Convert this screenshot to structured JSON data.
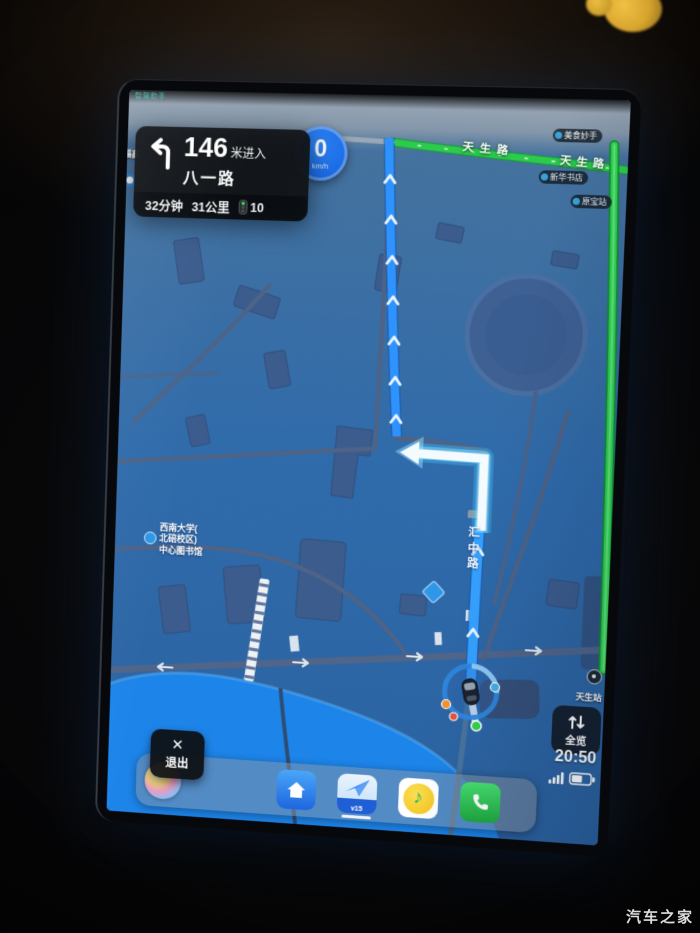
{
  "photo": {
    "watermark_text": "汽车之家"
  },
  "screen": {
    "top_status_text": "智驾助手",
    "nav": {
      "distance_value": "146",
      "distance_suffix": "米进入",
      "next_road": "八一路",
      "eta_time": "32分钟",
      "eta_distance": "31公里",
      "traffic_light_count": "10"
    },
    "speed": {
      "value": "0",
      "unit": "km/h"
    },
    "buttons": {
      "exit": "退出",
      "overview": "全览"
    },
    "statusbar": {
      "time": "20:50"
    },
    "dock": {
      "nav_badge": "v15"
    },
    "map_labels": {
      "road_green_1": "天生路",
      "road_green_2": "天生路",
      "route_road": "汇中路",
      "library_l1": "西南大学(",
      "library_l2": "北碚校区)",
      "library_l3": "中心图书馆",
      "poi_pill_1": "美食妙手",
      "poi_pill_2": "新华书店",
      "poi_pill_3": "原宝站",
      "poi_left_edge": "福鑫",
      "poi_green_end": "天生站"
    }
  }
}
